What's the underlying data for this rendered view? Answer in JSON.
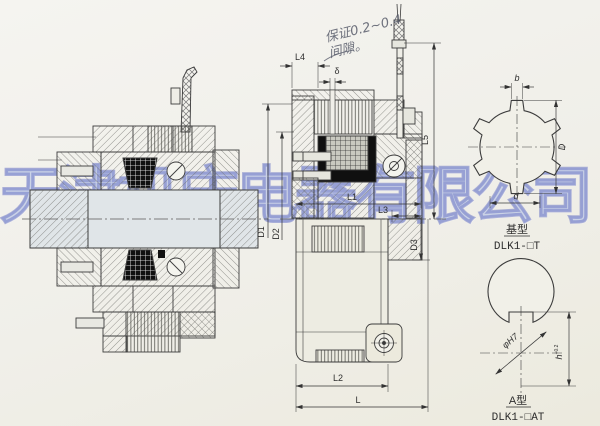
{
  "watermark": {
    "text": "天津机床电器有限公司",
    "color": "#8ea2da"
  },
  "note": {
    "line1": "保证0.2~0.4",
    "line2": "间隙。"
  },
  "dims": {
    "L4": "L4",
    "delta": "δ",
    "L5": "L5",
    "L1": "L1",
    "L3": "L3",
    "D1": "D1",
    "D2": "D2",
    "D3": "D3",
    "L2": "L2",
    "L": "L"
  },
  "spline": {
    "b": "b",
    "D": "D",
    "d": "d",
    "type": "基型",
    "model": "DLK1-□T"
  },
  "bore": {
    "dia": "φH7",
    "h": "h",
    "h_tol": "+0.2",
    "type": "A型",
    "model": "DLK1-□AT"
  }
}
